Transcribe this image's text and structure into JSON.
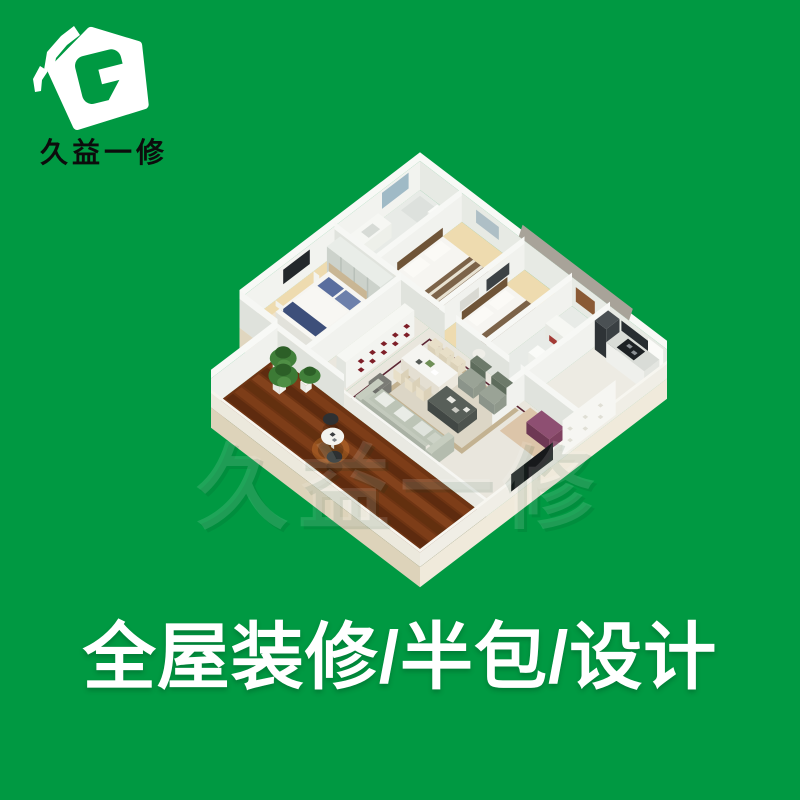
{
  "logo": {
    "brand_name": "久益一修"
  },
  "watermark": {
    "text": "久益一修"
  },
  "tagline": {
    "text": "全屋装修/半包/设计"
  },
  "colors": {
    "background": "#009942",
    "logo_house_white": "#ffffff",
    "logo_g_green": "#009942",
    "brand_text_black": "#0c0c0c",
    "tagline_white": "#ffffff",
    "wall_light": "#f2f3ef",
    "wall_shade": "#e0e3dd",
    "floor_cream_wood": "#eedbaf",
    "floor_tile": "#e9e6dd",
    "balcony_wood": "#6e3413",
    "tile_border_maroon": "#5c2634",
    "sofa_sage": "#b9c1b2",
    "armchair_green": "#5e6c5c",
    "bench_purple": "#7e3f63",
    "plant_green": "#41803a",
    "bed_blanket_brown": "#7c6349",
    "pillow_blue": "#5a6e9e",
    "counter_dark": "#1d2124"
  },
  "floor_plan": {
    "rooms": [
      "master-bedroom",
      "bathroom-1",
      "bedroom-2",
      "bedroom-3",
      "bathroom-2",
      "kitchen",
      "hallway",
      "dining-room",
      "living-room",
      "entry",
      "balcony"
    ]
  }
}
